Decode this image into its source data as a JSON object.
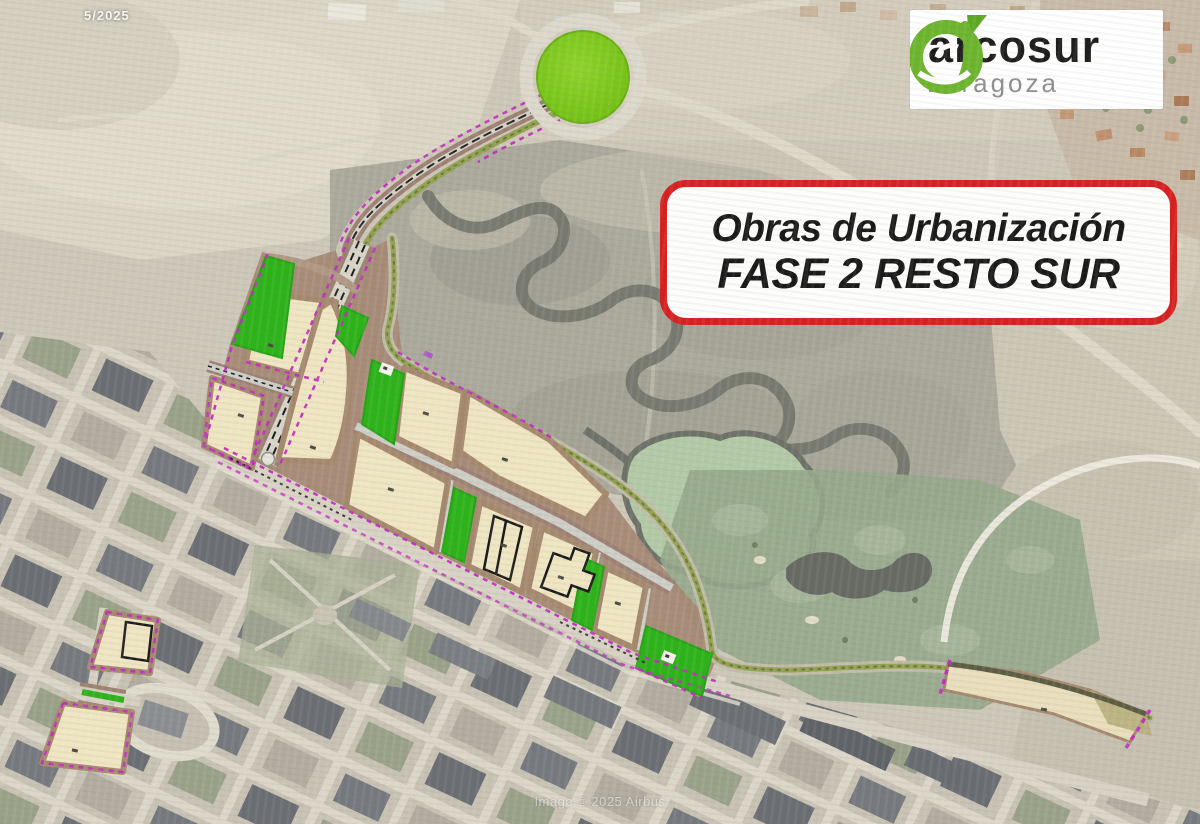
{
  "logo": {
    "name": "arcosur",
    "city": "zaragoza"
  },
  "callout": {
    "line1": "Obras de Urbanización",
    "line2": "FASE 2 RESTO SUR"
  },
  "stamps": {
    "date": "5/2025",
    "attribution": "Image © 2025 Airbus"
  },
  "colors": {
    "callout_border_red": "#d81f1f",
    "callout_text": "#191919",
    "logo_green": "#6cb52d",
    "logo_name_black": "#1d1d1b",
    "logo_city_gray": "#8f8f8f",
    "roundabout_green": "#7cc51d",
    "park_green": "#2db31a",
    "parcel_tan": "#efe5c2",
    "parcel_frame_brown": "#a5896f",
    "road_brown": "#9d8173",
    "road_gray": "#d2cfc4",
    "tree_row_olive": "#93a254",
    "boundary_magenta": "#c22ec0"
  }
}
